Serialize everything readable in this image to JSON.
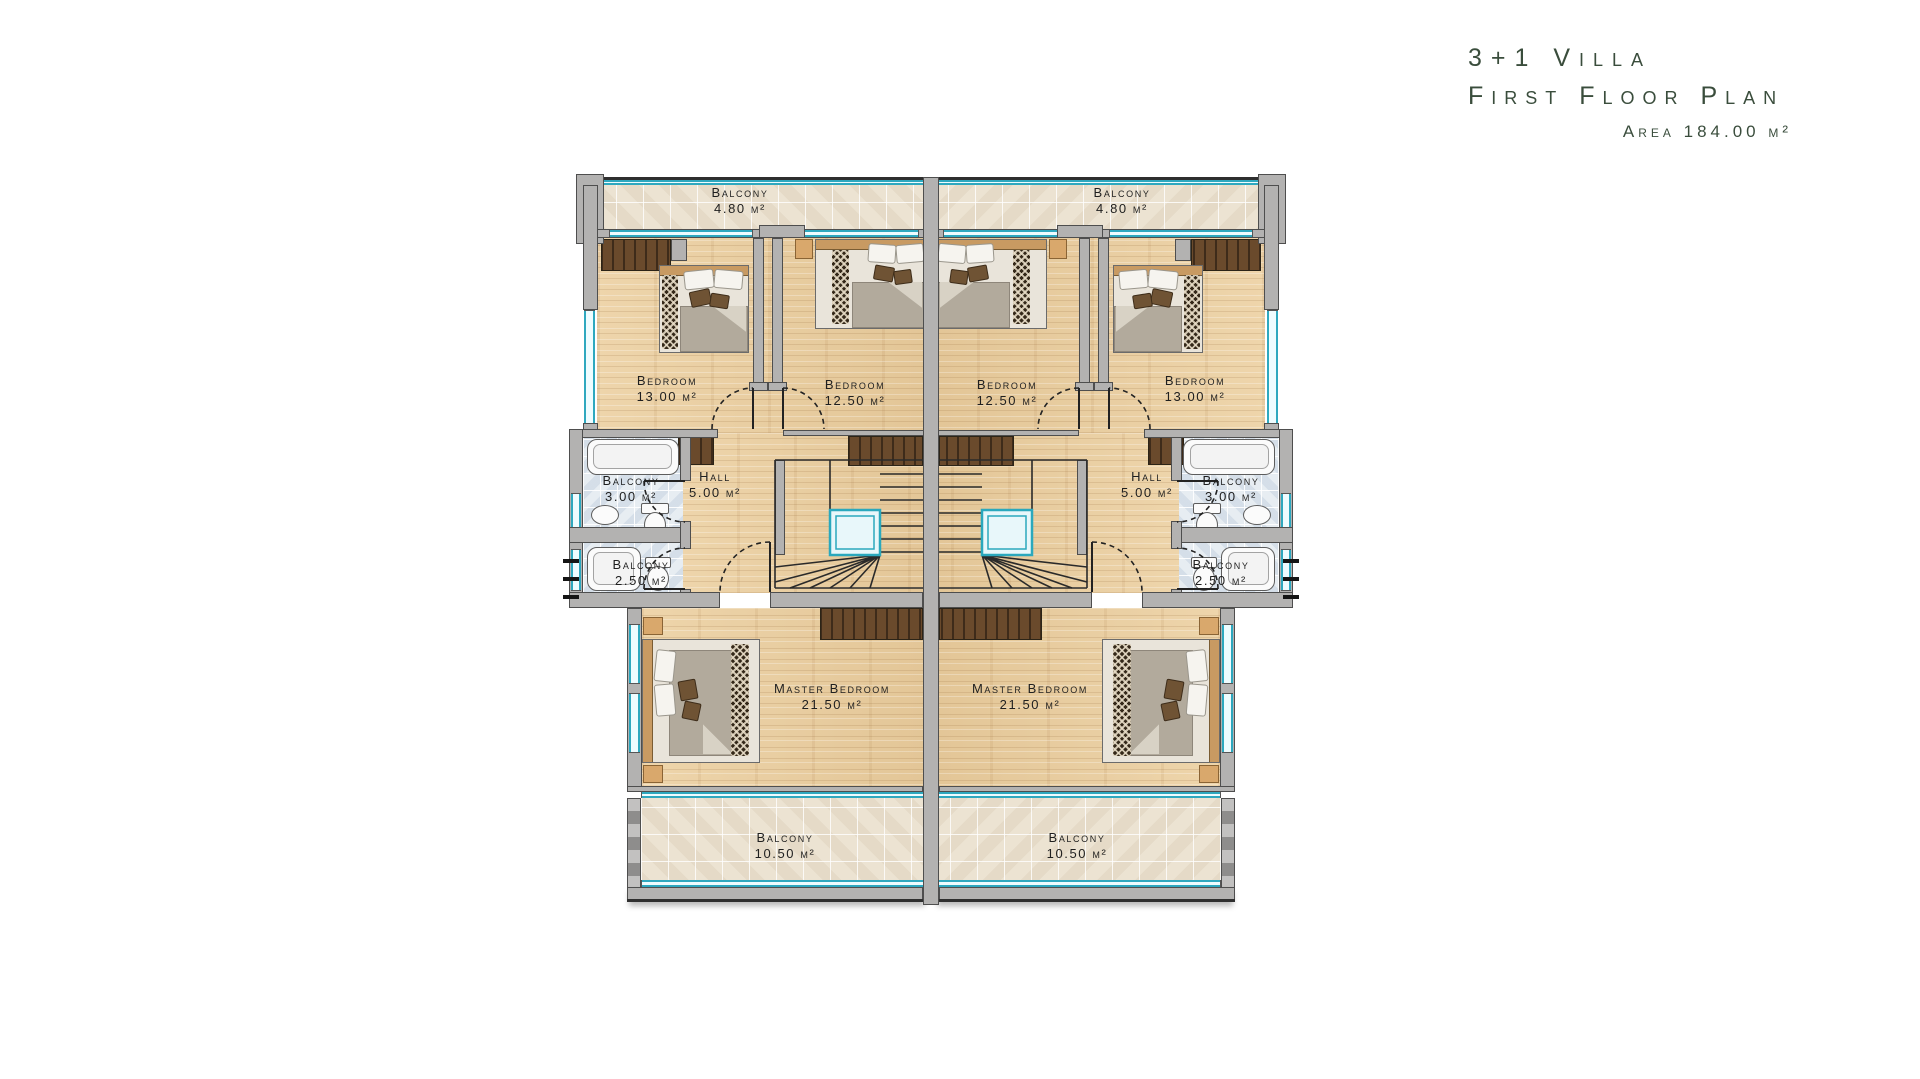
{
  "title": {
    "product": "3+1 Villa",
    "subtitle": "First Floor Plan",
    "area": "Area 184.00 m²"
  },
  "plan": {
    "rooms": {
      "balcony_top": {
        "name": "Balcony",
        "area": "4.80 m²"
      },
      "bedroom_large": {
        "name": "Bedroom",
        "area": "13.00 m²"
      },
      "bedroom_small": {
        "name": "Bedroom",
        "area": "12.50 m²"
      },
      "hall": {
        "name": "Hall",
        "area": "5.00 m²"
      },
      "bath_upper": {
        "name": "Balcony",
        "area": "3.00 m²"
      },
      "bath_lower": {
        "name": "Balcony",
        "area": "2.50 m²"
      },
      "master": {
        "name": "Master Bedroom",
        "area": "21.50 m²"
      },
      "balcony_bottom": {
        "name": "Balcony",
        "area": "10.50 m²"
      }
    },
    "colors": {
      "wall": "#b3b2b1",
      "window": "#2ea8bf",
      "wood_floor": "#e9cfa4",
      "balcony_tile": "#ece3d2",
      "bath_tile": "#e7edf2",
      "closet": "#6a4a2c",
      "title_text": "#3a4d3c",
      "label_text": "#1f1f1f"
    }
  }
}
